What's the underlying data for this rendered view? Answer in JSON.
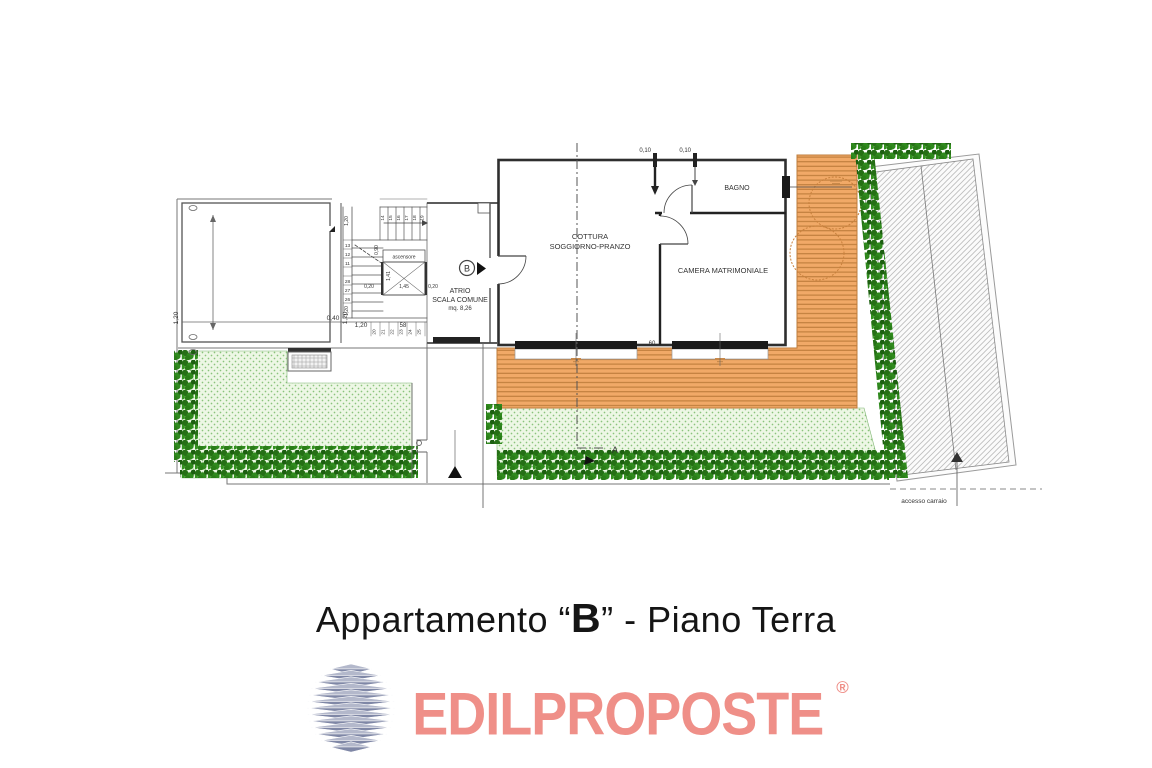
{
  "caption": {
    "prefix": "Appartamento “",
    "unit_letter": "B",
    "suffix": "” - Piano Terra"
  },
  "logo": {
    "brand": "EDILPROPOSTE",
    "registered_mark": "®"
  },
  "plan": {
    "rooms": {
      "living_line1": "COTTURA",
      "living_line2": "SOGGIORNO-PRANZO",
      "bedroom": "CAMERA MATRIMONIALE",
      "bathroom": "BAGNO",
      "atrium_line1": "ATRIO",
      "atrium_line2": "SCALA COMUNE",
      "atrium_area": "mq. 8,26",
      "elevator": "ascensore"
    },
    "markers": {
      "unit_door": "B",
      "section": "A",
      "driveway_access": "accesso carraio"
    },
    "dimensions": {
      "top_wall_left": "0,10",
      "top_wall_right": "0,10",
      "window_gap": "60",
      "block_left": "1,20",
      "block_bottom_1": "0,40",
      "block_bottom_2": "1,20",
      "block_bottom_3": "1,20",
      "stair_width": "58",
      "stair_left_top": "1,20",
      "stair_left_bottom": "1,20",
      "elev_top": "0,90",
      "elev_height": "1,41",
      "elev_width": "1,45",
      "elev_side_right": "0,20",
      "elev_side_left": "0,20"
    },
    "stair_numbers": {
      "top_row": [
        "14",
        "15",
        "16",
        "17",
        "18",
        "19"
      ],
      "left_col": [
        "13",
        "12",
        "11",
        "28",
        "27",
        "26"
      ],
      "bottom_row": [
        "20",
        "21",
        "22",
        "23",
        "24",
        "25"
      ]
    },
    "colors": {
      "deck": "#F1A967",
      "deck_line": "#BE7C3B",
      "garden": "#EDF7E5",
      "garden_dot": "#8BC47C",
      "hedge_dark": "#256F15",
      "hedge_light": "#2F8A1D",
      "wall": "#2E2E2E",
      "drawing_line": "#666666",
      "logo_text": "#EF8F88",
      "logo_icon_top": "#B3B8CB",
      "logo_icon_bottom": "#7F87A6"
    }
  }
}
